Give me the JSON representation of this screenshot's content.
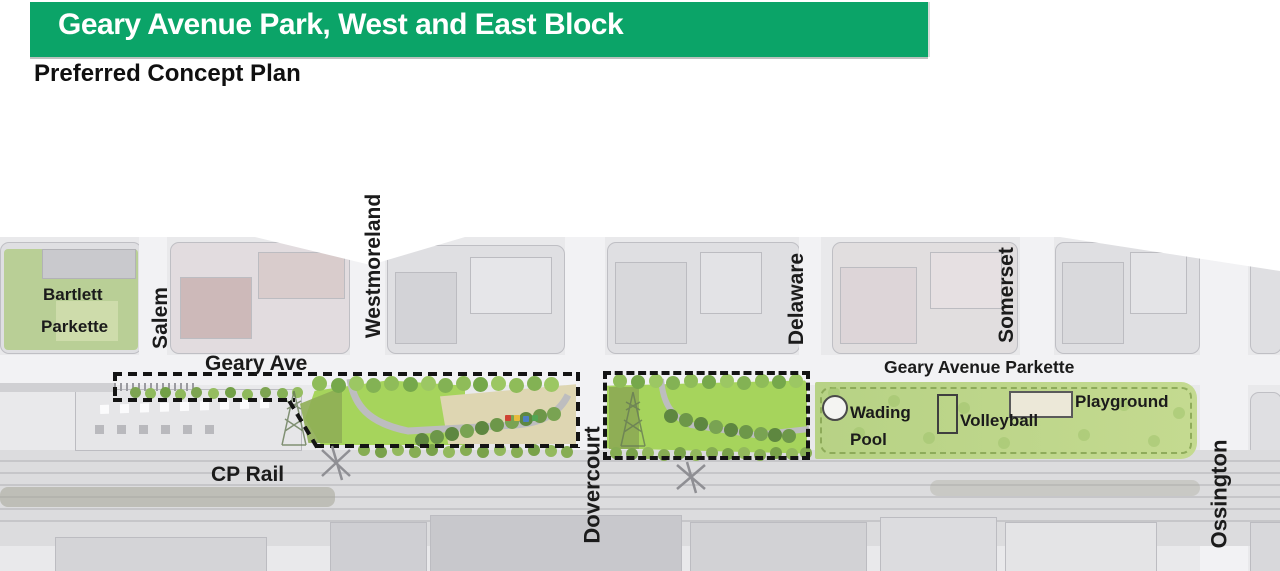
{
  "header": {
    "title": "Geary Avenue Park, West and East Block",
    "subtitle": "Preferred Concept Plan",
    "banner_color": "#0ba468"
  },
  "map": {
    "streets": [
      {
        "id": "salem",
        "label": "Salem"
      },
      {
        "id": "westmoreland",
        "label": "Westmoreland"
      },
      {
        "id": "dovercourt",
        "label": "Dovercourt"
      },
      {
        "id": "delaware",
        "label": "Delaware"
      },
      {
        "id": "somerset",
        "label": "Somerset"
      },
      {
        "id": "ossington",
        "label": "Ossington"
      }
    ],
    "roads": {
      "geary_ave": "Geary Ave",
      "cp_rail": "CP Rail"
    },
    "parks": {
      "bartlett_line1": "Bartlett",
      "bartlett_line2": "Parkette",
      "geary_parkette": "Geary Avenue Parkette"
    },
    "features": {
      "wading_line1": "Wading",
      "wading_line2": "Pool",
      "volleyball": "Volleyball",
      "playground": "Playground"
    }
  }
}
